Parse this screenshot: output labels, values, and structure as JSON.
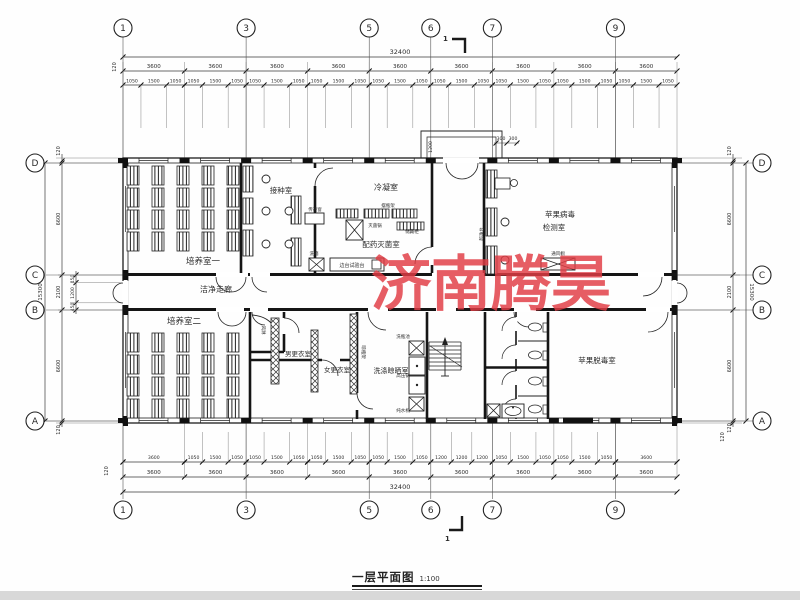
{
  "meta": {
    "title": "一层平面图",
    "scale": "1:100",
    "watermark": "济南腾昊",
    "watermark_color": "#e13c44",
    "section_mark": "1"
  },
  "axes": {
    "top": [
      {
        "label": "1",
        "bay": 0
      },
      {
        "label": "3",
        "bay": 2
      },
      {
        "label": "5",
        "bay": 4
      },
      {
        "label": "6",
        "bay": 5
      },
      {
        "label": "7",
        "bay": 6
      },
      {
        "label": "9",
        "bay": 8
      }
    ],
    "bottom": [
      {
        "label": "1",
        "bay": 0
      },
      {
        "label": "3",
        "bay": 2
      },
      {
        "label": "5",
        "bay": 4
      },
      {
        "label": "6",
        "bay": 5
      },
      {
        "label": "7",
        "bay": 6
      },
      {
        "label": "9",
        "bay": 8
      }
    ],
    "left": [
      {
        "label": "D",
        "y": 163
      },
      {
        "label": "C",
        "y": 275
      },
      {
        "label": "B",
        "y": 310
      },
      {
        "label": "A",
        "y": 421
      }
    ],
    "right": [
      {
        "label": "D",
        "y": 163
      },
      {
        "label": "C",
        "y": 275
      },
      {
        "label": "B",
        "y": 310
      },
      {
        "label": "A",
        "y": 421
      }
    ]
  },
  "dims": {
    "overall_width": "32400",
    "overall_height": "15300",
    "edge": "120",
    "top_main": [
      "3600",
      "3600",
      "3600",
      "3600",
      "3600",
      "3600",
      "3600",
      "3600",
      "3600"
    ],
    "top_sub": [
      [
        "1050",
        "1500",
        "1050"
      ],
      [
        "1050",
        "1500",
        "1050"
      ],
      [
        "1050",
        "1500",
        "1050"
      ],
      [
        "1050",
        "1500",
        "1050"
      ],
      [
        "1050",
        "1500",
        "1050"
      ],
      [
        "1050",
        "1500",
        "1050"
      ],
      [
        "1050",
        "1500",
        "1050"
      ],
      [
        "1050",
        "1500",
        "1050"
      ],
      [
        "1050",
        "1500",
        "1050"
      ]
    ],
    "bottom_main": [
      "3600",
      "3600",
      "3600",
      "3600",
      "3600",
      "3600",
      "3600",
      "3600",
      "3600"
    ],
    "bottom_sub": [
      [
        "3600"
      ],
      [
        "1050",
        "1500",
        "1050"
      ],
      [
        "1050",
        "1500",
        "1050"
      ],
      [
        "1050",
        "1500",
        "1050"
      ],
      [
        "1050",
        "1500",
        "1050"
      ],
      [
        "1200",
        "1200",
        "1200"
      ],
      [
        "1050",
        "1500",
        "1050"
      ],
      [
        "1050",
        "1500",
        "1050"
      ],
      [
        "3600"
      ]
    ],
    "left_main": [
      "120",
      "6600",
      "2100",
      "6600",
      "120"
    ],
    "left_detail": [
      "450",
      "1200",
      "450"
    ],
    "right_main": [
      "120",
      "6600",
      "2100",
      "6600",
      "120"
    ],
    "porch_depth": "1200",
    "porch_sides": [
      "300",
      "300"
    ]
  },
  "rooms": [
    {
      "label": "培养室一",
      "x": 203,
      "y": 264,
      "s": 8.5
    },
    {
      "label": "接种室",
      "x": 281,
      "y": 193,
      "s": 7.5
    },
    {
      "label": "冷凝室",
      "x": 386,
      "y": 190,
      "s": 8
    },
    {
      "label": "配药灭菌室",
      "x": 381,
      "y": 247,
      "s": 7.5
    },
    {
      "label": "苹果病毒",
      "x": 560,
      "y": 217,
      "s": 7.5
    },
    {
      "label": "检测室",
      "x": 554,
      "y": 230,
      "s": 7.5
    },
    {
      "label": "洁净走廊",
      "x": 216,
      "y": 292,
      "s": 8
    },
    {
      "label": "培养室二",
      "x": 184,
      "y": 324,
      "s": 8.5
    },
    {
      "label": "男更衣室",
      "x": 298,
      "y": 356,
      "s": 6.5
    },
    {
      "label": "女更衣室",
      "x": 337,
      "y": 372,
      "s": 6.5
    },
    {
      "label": "洗涤晾晒室",
      "x": 391,
      "y": 373,
      "s": 7
    },
    {
      "label": "苹果脱毒室",
      "x": 597,
      "y": 363,
      "s": 7.5
    }
  ],
  "equipment": [
    {
      "label": "传递窗",
      "x": 315,
      "y": 211,
      "s": 4.5
    },
    {
      "label": "摆瓶架",
      "x": 388,
      "y": 207,
      "s": 4.5
    },
    {
      "label": "灭菌锅",
      "x": 375,
      "y": 227,
      "s": 4.5
    },
    {
      "label": "储藏柜",
      "x": 412,
      "y": 233,
      "s": 4.5
    },
    {
      "label": "洗箱",
      "x": 314,
      "y": 255,
      "s": 4.5
    },
    {
      "label": "边台试验台",
      "x": 352,
      "y": 267,
      "s": 5
    },
    {
      "label": "超净台",
      "x": 483,
      "y": 234,
      "s": 4.5,
      "rot": -90
    },
    {
      "label": "通风橱",
      "x": 558,
      "y": 255,
      "s": 4.5
    },
    {
      "label": "风淋",
      "x": 262,
      "y": 330,
      "s": 4.5,
      "rot": 90
    },
    {
      "label": "晾瓶架",
      "x": 362,
      "y": 352,
      "s": 4.5,
      "rot": 90
    },
    {
      "label": "洗瓶池",
      "x": 403,
      "y": 338,
      "s": 4.5
    },
    {
      "label": "高压锅",
      "x": 403,
      "y": 377,
      "s": 4.5
    },
    {
      "label": "纯水机",
      "x": 403,
      "y": 412,
      "s": 4.5
    }
  ]
}
